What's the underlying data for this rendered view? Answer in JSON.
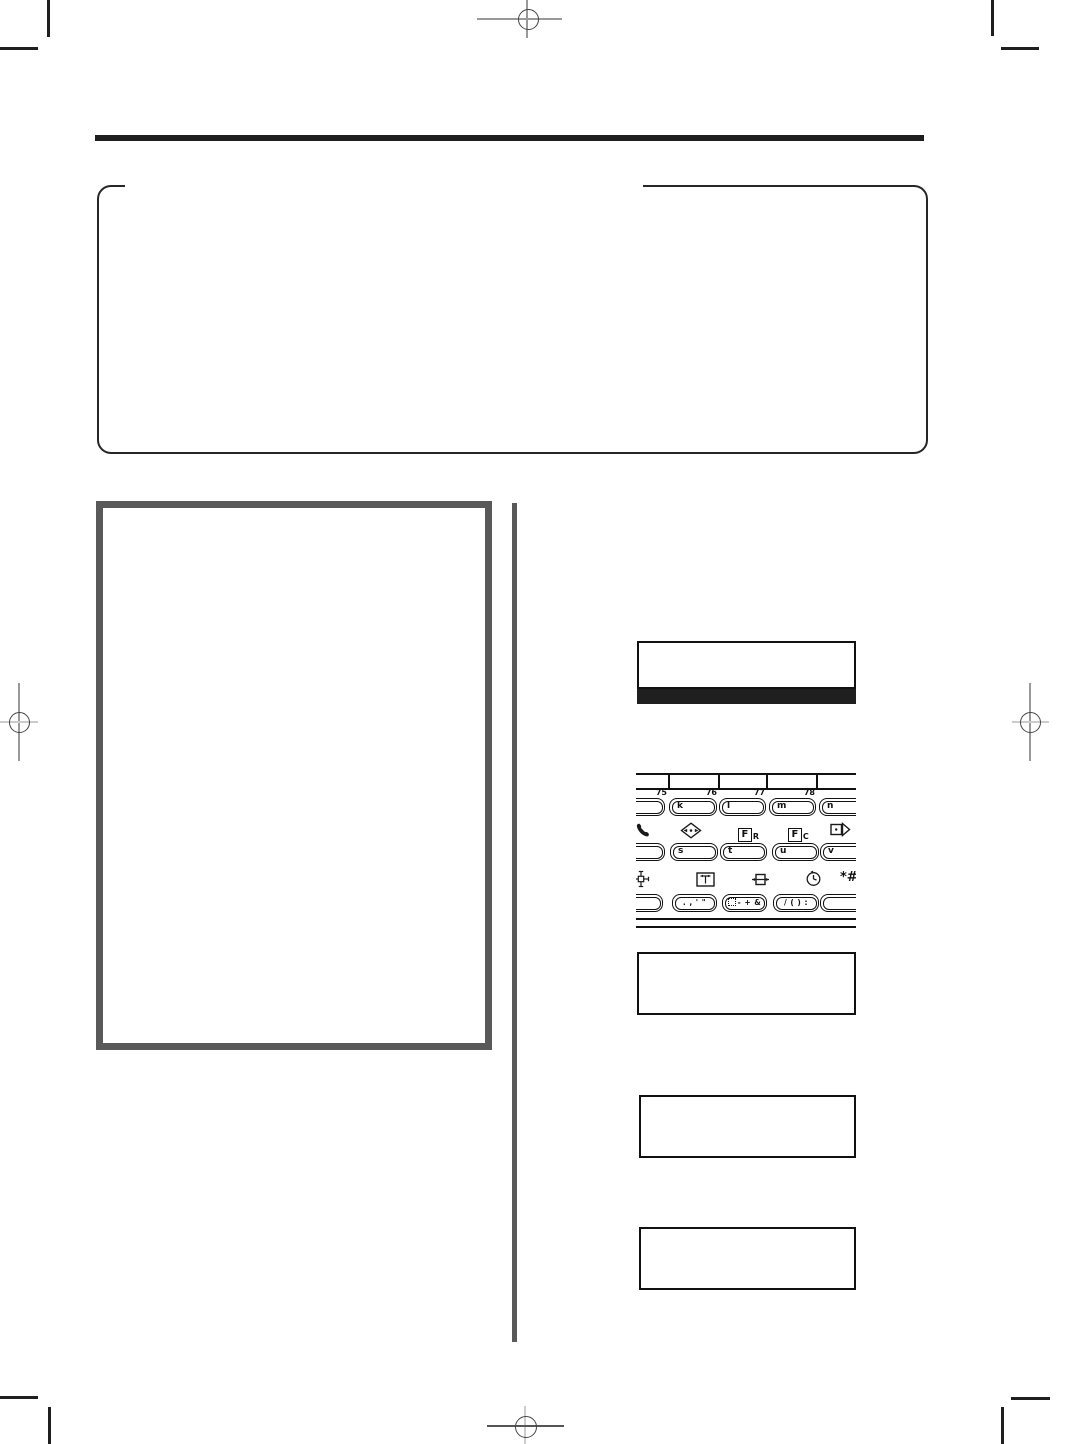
{
  "page": {
    "type": "scanned-manual-page",
    "background": "#ffffff"
  },
  "colors": {
    "ink": "#1f1f1f",
    "frame_gray": "#595959",
    "register_mark_gray": "#999999",
    "register_mark_light": "#cccccc"
  },
  "keypad": {
    "numbers": [
      "75",
      "76",
      "77",
      "78"
    ],
    "row1_keys": [
      "k",
      "l",
      "m",
      "n"
    ],
    "row2_keys": [
      "s",
      "t",
      "u",
      "v"
    ],
    "row3_keys": [
      ". , ' \"",
      "- + &",
      "/ ( ) :"
    ],
    "fr": {
      "main": "F",
      "sub": "R"
    },
    "fc": {
      "main": "F",
      "sub": "C"
    },
    "star_hash": "*#"
  }
}
